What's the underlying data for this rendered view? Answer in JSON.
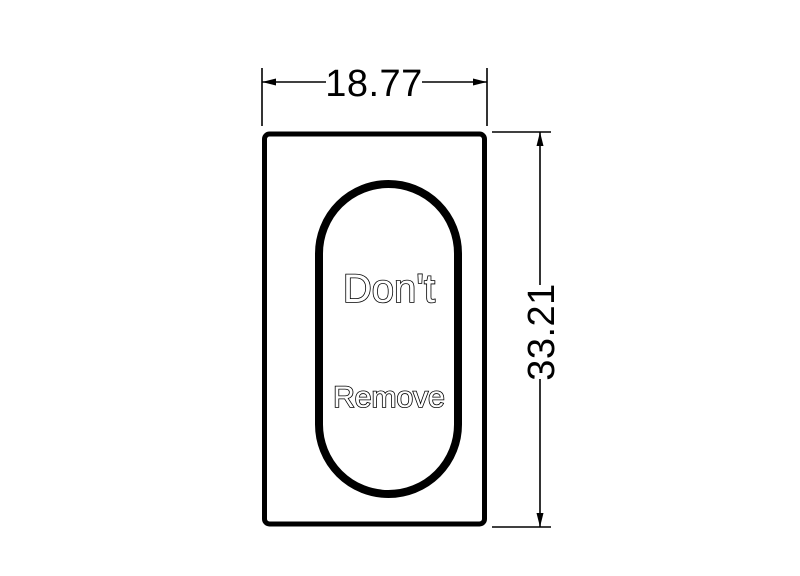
{
  "drawing": {
    "slot_label": {
      "line1": "Don't",
      "line2": "Remove"
    },
    "dimensions": {
      "width_value": "18.77",
      "height_value": "33.21"
    }
  },
  "colors": {
    "line": "#000000",
    "background": "#ffffff",
    "outline_text_fill": "#ffffff"
  }
}
